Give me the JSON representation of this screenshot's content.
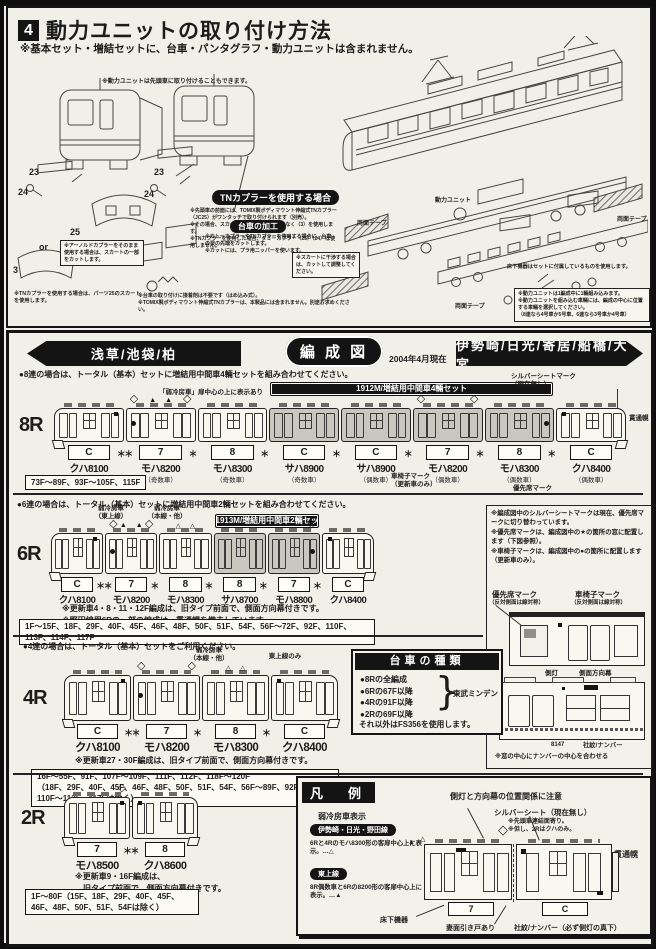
{
  "top": {
    "num": "4",
    "title": "動力ユニットの取り付け方法",
    "subtitle": "※基本セット・増結セットに、台車・パンタグラフ・動力ユニットは含まれません。",
    "front_note": "※動力ユニットは先頭車に取り付けることもできます。",
    "tn_badge": "TNカプラーを使用する場合",
    "tn_notes": [
      "※先頭車の前面には、TOMIX製ボディマウント伸縮式TNカプラー（JC25）がワンタッチで取り付けられます（別売）。",
      "※その場合、スカートパーツは（25）ではなく（3）を使用します。",
      "※TNカプラーを使用した場合、ダミーカプラー（25）（24）は使用しません。"
    ],
    "bogie_badge": "台車の加工",
    "bogie_notes": [
      "※カトーカプラーやTNカプラーを使用する場合に、台車の梁の先端をカットします。",
      "※カットには、プラ用ニッパーを使います。"
    ],
    "skirt_adjust_note": "※スカートに干渉する場合は、カットして調整してください。",
    "arnold_note": "※アーノルドカプラーをそのまま使用する場合は、スカートの一部をカットします。",
    "skirt_use_note": "※TNカプラーを使用する場合は、パーツ25のスカートを使用します。",
    "assembly_notes": [
      "※台車の取り付けに接着剤は不要です（はめ込み式）。",
      "※TOMIX製ボディマウント伸縮式TNカプラーは、本製品には含まれません。別途お求めください。"
    ],
    "power_unit_label": "動力ユニット",
    "tape_label": "両面テープ",
    "underfloor_note": "床下機器はセットに付属しているものを使用します。",
    "power_notes": [
      "※動力ユニットは1編成中に1輛組み込みます。",
      "※動力ユニットを組み込む車輛には、編成の中心に位置する車輛を選択してください。",
      "（8連なら4号車か5号車、6連なら3号車か4号車）"
    ],
    "parts": {
      "p23": "23",
      "p24": "24",
      "p25": "25",
      "or": "or",
      "p3": "3"
    }
  },
  "formation": {
    "left_dest": "浅草/池袋/柏",
    "title": "編 成 図",
    "date": "2004年4月現在",
    "right_dest": "伊勢崎/日光/寄居/船橋/大宮",
    "rows": [
      {
        "id": "8R",
        "note": "●8連の場合は、トータル（基本）セットに増結用中間車4輛セットを組み合わせてください。",
        "bar": {
          "text": "1912M/増結用中間車4輛セット",
          "from": 3,
          "to": 6
        },
        "callouts": [
          "「弱冷房車」扉中心の上に表示あり"
        ],
        "silver_note": "シルバーシートマーク\n（現在無し）",
        "gangway_label": "貫通幌",
        "cars": [
          {
            "name": "クハ8100",
            "sub": "（奇数車）",
            "plate": "C",
            "end": "left",
            "sq": "right"
          },
          {
            "name": "モハ8200",
            "sub": "（奇数車）",
            "plate": "7",
            "panto": "both",
            "dot": "left",
            "tris": "▲▲"
          },
          {
            "name": "モハ8300",
            "sub": "（奇数車）",
            "plate": "8"
          },
          {
            "name": "サハ8900",
            "sub": "（奇数車）",
            "plate": "C",
            "shaded": true
          },
          {
            "name": "サハ8900",
            "sub": "（偶数車）",
            "plate": "C",
            "shaded": true
          },
          {
            "name": "モハ8200",
            "sub": "（偶数車）",
            "plate": "7",
            "shaded": true,
            "panto": "both"
          },
          {
            "name": "モハ8300",
            "sub": "（偶数車）",
            "plate": "8",
            "shaded": true,
            "dot": "right"
          },
          {
            "name": "クハ8400",
            "sub": "（偶数車）",
            "plate": "C",
            "end": "right",
            "sq": "left"
          }
        ],
        "joints": [
          "＊＊",
          "＊",
          "＊",
          "＊",
          "＊",
          "＊",
          "＊"
        ],
        "mark_notes": [
          "車椅子マーク\n（更新車のみ）",
          "優先席マーク"
        ],
        "fleet": "73F～89F、93F～105F、115F"
      },
      {
        "id": "6R",
        "note": "●6連の場合は、トータル（基本）セットに増結用中間車2輛セットを組み合わせてください。",
        "bar": {
          "text": "1913M/増結用中間車2輛セット",
          "from": 3,
          "to": 4
        },
        "callouts": [
          "弱冷房車\n（東上線）",
          "弱冷房車\n（本線・他）"
        ],
        "cars": [
          {
            "name": "クハ8100",
            "plate": "C",
            "end": "left",
            "sq": "right"
          },
          {
            "name": "モハ8200",
            "plate": "7",
            "panto": "both",
            "dot": "left",
            "tris": "▲▲"
          },
          {
            "name": "モハ8300",
            "plate": "8",
            "tris": "△△"
          },
          {
            "name": "サハ8700",
            "plate": "8",
            "shaded": true
          },
          {
            "name": "モハ8800",
            "plate": "7",
            "shaded": true,
            "panto": "right",
            "dot": "right"
          },
          {
            "name": "クハ8400",
            "plate": "C",
            "end": "right",
            "sq": "left"
          }
        ],
        "joints": [
          "＊＊",
          "＊",
          "＊",
          "＊",
          "＊"
        ],
        "notes": [
          "※更新車4・8・11・12F編成は、旧タイプ前面で、側面方向幕付きです。",
          "※野田線用6Rの一部の編成は、貫通幌を撤去しています。"
        ],
        "fleet": "1F～15F、18F、29F、40F、45F、46F、48F、50F、51F、54F、56F～72F、92F、110F、113F、114F、117F"
      },
      {
        "id": "4R",
        "note": "●4連の場合は、トータル（基本）セットをご利用ください。",
        "callouts": [
          "弱冷房車\n（本線・他）",
          "東上線のみ"
        ],
        "cars": [
          {
            "name": "クハ8100",
            "plate": "C",
            "end": "left",
            "sq": "right"
          },
          {
            "name": "モハ8200",
            "plate": "7",
            "panto": "both",
            "dot": "left"
          },
          {
            "name": "モハ8300",
            "plate": "8",
            "tris": "△△"
          },
          {
            "name": "クハ8400",
            "plate": "C",
            "end": "right",
            "sq": "left"
          }
        ],
        "joints": [
          "＊＊",
          "＊",
          "＊"
        ],
        "notes": [
          "※更新車27・30F編成は、旧タイプ前面で、側面方向幕付きです。"
        ],
        "fleet": "16F～55F、91F、107F～109F、111F、112F、118F～120F\n（18F、29F、40F、45F、46F、48F、50F、51F、54F、56F～89F、92F～106F、110F～113F、117Fは除く）"
      },
      {
        "id": "2R",
        "cars": [
          {
            "name": "モハ8500",
            "plate": "7",
            "end": "left",
            "panto": "right",
            "sq": "right"
          },
          {
            "name": "クハ8600",
            "plate": "8",
            "end": "right",
            "sq": "left"
          }
        ],
        "joints": [
          "＊＊"
        ],
        "notes": [
          "※更新車9・16F編成は、",
          "　旧タイプ前面で、側面方向幕付きです。"
        ],
        "fleet": "1F～80F（15F、18F、29F、40F、45F、46F、48F、50F、51F、54Fは除く）"
      }
    ],
    "side_notes": {
      "lines": [
        "※編成図中のシルバーシートマークは現在、優先席マークに切り替わっています。",
        "※優先席マークは、編成図中の★の箇所の窓に配置します（下図参照）。",
        "※車椅子マークは、編成図中の●の箇所に配置します（更新車のみ）。"
      ],
      "priority_label": "優先席マーク",
      "priority_sub": "（反対側面は線対称）",
      "wheelchair_label": "車椅子マーク",
      "wheelchair_sub": "（反対側面は線対称）",
      "sidelight_label": "側灯",
      "rollsign_label": "側面方向幕",
      "sample_number": "8147",
      "crest_label": "社紋/ナンバー",
      "center_note": "※窓の中心にナンバーの中心を合わせる"
    },
    "bogie_box": {
      "title": "台車の種類",
      "items": [
        "●8Rの全編成",
        "●6Rの67F以降",
        "●4Rの91F以降",
        "●2Rの69F以降"
      ],
      "brace": "}",
      "brace_label": "東武ミンデン",
      "footer": "それ以外はFS356を使用します。"
    },
    "legend": {
      "title": "凡　例",
      "weak_ac_title": "弱冷房車表示",
      "badge1": "伊勢崎・日光・野田線",
      "text1": "6Rと4Rのモハ8300形の客扉中心上に表示。…△",
      "badge2": "東上線",
      "text2": "8R偶数車と6Rの8200形の客扉中心上に表示。…▲",
      "tri_filled": "▲",
      "tri_hollow": "△",
      "diamond": "◇",
      "callout_sidelight": "側灯と方向幕の位置関係に注意",
      "callout_silver": "シルバーシート（現在無し）",
      "silver_sub1": "※先頭車連結面寄り。",
      "silver_sub2": "※但し、2Rはクハのみ。",
      "callout_gangway": "貫通幌",
      "callout_underfloor": "床下機器",
      "callout_door": "妻面引き戸あり",
      "callout_crest": "社紋/ナンバー（必ず側灯の真下）",
      "plate_left": "7",
      "plate_right": "C"
    }
  }
}
